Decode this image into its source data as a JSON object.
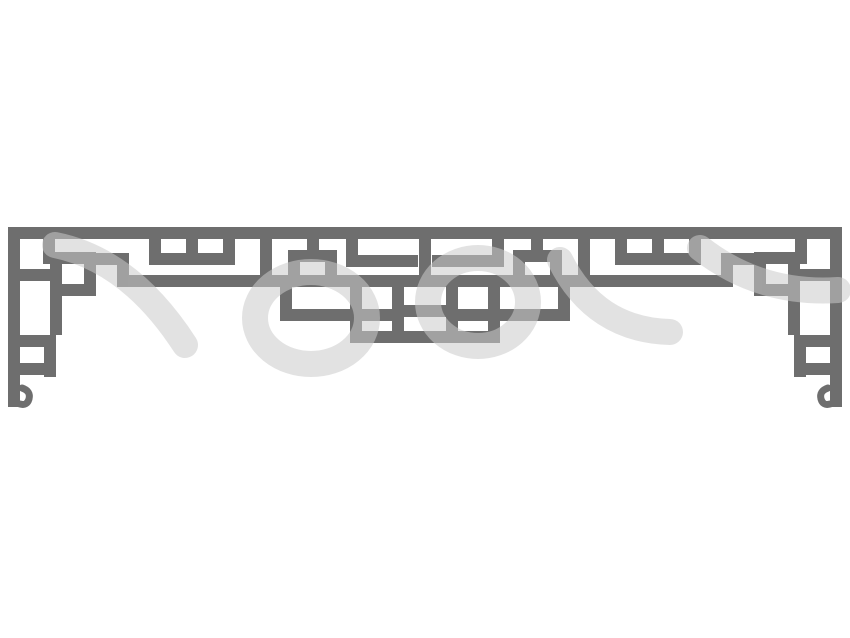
{
  "artwork": {
    "title": "chinese-lattice-transom",
    "canvas": {
      "width": 850,
      "height": 638
    },
    "background_color": "#ffffff",
    "lattice_color": "#6e6e6e",
    "watermark_color": "#cbcbcb",
    "watermark_opacity": 0.55,
    "bar_thickness": 12,
    "bars": [
      [
        8,
        227,
        834,
        12
      ],
      [
        8,
        227,
        12,
        180
      ],
      [
        830,
        227,
        12,
        180
      ],
      [
        8,
        363,
        48,
        12
      ],
      [
        794,
        363,
        48,
        12
      ],
      [
        44,
        347,
        12,
        30
      ],
      [
        794,
        347,
        12,
        30
      ],
      [
        43,
        239,
        12,
        25
      ],
      [
        50,
        252,
        46,
        12
      ],
      [
        50,
        252,
        12,
        44
      ],
      [
        84,
        252,
        12,
        44
      ],
      [
        50,
        284,
        46,
        12
      ],
      [
        20,
        269,
        30,
        12
      ],
      [
        50,
        296,
        12,
        39
      ],
      [
        20,
        335,
        36,
        12
      ],
      [
        96,
        253,
        33,
        12
      ],
      [
        117,
        253,
        12,
        34
      ],
      [
        149,
        253,
        86,
        12
      ],
      [
        149,
        239,
        12,
        14
      ],
      [
        186,
        239,
        12,
        14
      ],
      [
        223,
        239,
        12,
        14
      ],
      [
        260,
        239,
        12,
        48
      ],
      [
        117,
        275,
        233,
        12
      ],
      [
        288,
        250,
        49,
        12
      ],
      [
        288,
        250,
        12,
        37
      ],
      [
        325,
        250,
        12,
        37
      ],
      [
        307,
        239,
        12,
        11
      ],
      [
        280,
        287,
        12,
        34
      ],
      [
        280,
        309,
        112,
        12
      ],
      [
        795,
        239,
        12,
        25
      ],
      [
        754,
        252,
        46,
        12
      ],
      [
        788,
        252,
        12,
        44
      ],
      [
        754,
        252,
        12,
        44
      ],
      [
        754,
        284,
        46,
        12
      ],
      [
        800,
        269,
        30,
        12
      ],
      [
        788,
        296,
        12,
        39
      ],
      [
        794,
        335,
        36,
        12
      ],
      [
        721,
        253,
        33,
        12
      ],
      [
        721,
        253,
        12,
        34
      ],
      [
        615,
        253,
        86,
        12
      ],
      [
        689,
        239,
        12,
        14
      ],
      [
        652,
        239,
        12,
        14
      ],
      [
        615,
        239,
        12,
        14
      ],
      [
        578,
        239,
        12,
        48
      ],
      [
        500,
        275,
        233,
        12
      ],
      [
        513,
        250,
        49,
        12
      ],
      [
        550,
        250,
        12,
        37
      ],
      [
        513,
        250,
        12,
        37
      ],
      [
        531,
        239,
        12,
        11
      ],
      [
        558,
        287,
        12,
        34
      ],
      [
        458,
        309,
        112,
        12
      ],
      [
        346,
        239,
        12,
        16
      ],
      [
        492,
        239,
        12,
        16
      ],
      [
        346,
        255,
        72,
        12
      ],
      [
        432,
        255,
        72,
        12
      ],
      [
        419,
        239,
        12,
        48
      ],
      [
        350,
        275,
        150,
        12
      ],
      [
        350,
        331,
        150,
        12
      ],
      [
        350,
        275,
        12,
        68
      ],
      [
        488,
        275,
        12,
        68
      ],
      [
        392,
        287,
        12,
        44
      ],
      [
        446,
        287,
        12,
        44
      ],
      [
        350,
        309,
        54,
        12
      ],
      [
        446,
        309,
        54,
        12
      ],
      [
        404,
        305,
        42,
        12
      ]
    ],
    "hooks": [
      {
        "name": "scroll-hook-left",
        "d": "M22,388 q9,3 7,11 q-2,7 -9,5"
      },
      {
        "name": "scroll-hook-right",
        "d": "M828,388 q-9,3 -7,11 q2,7 9,5"
      }
    ],
    "watermark_strokes": [
      "M55,245 Q130,260 185,345",
      "M255,318 a56,46 0 1 0 112,0 a56,46 0 1 0 -112,0",
      "M428,302 a50,44 0 1 0 100,0 a50,44 0 1 0 -100,0",
      "M560,260 Q595,330 670,332",
      "M700,248 Q760,295 838,290"
    ]
  }
}
